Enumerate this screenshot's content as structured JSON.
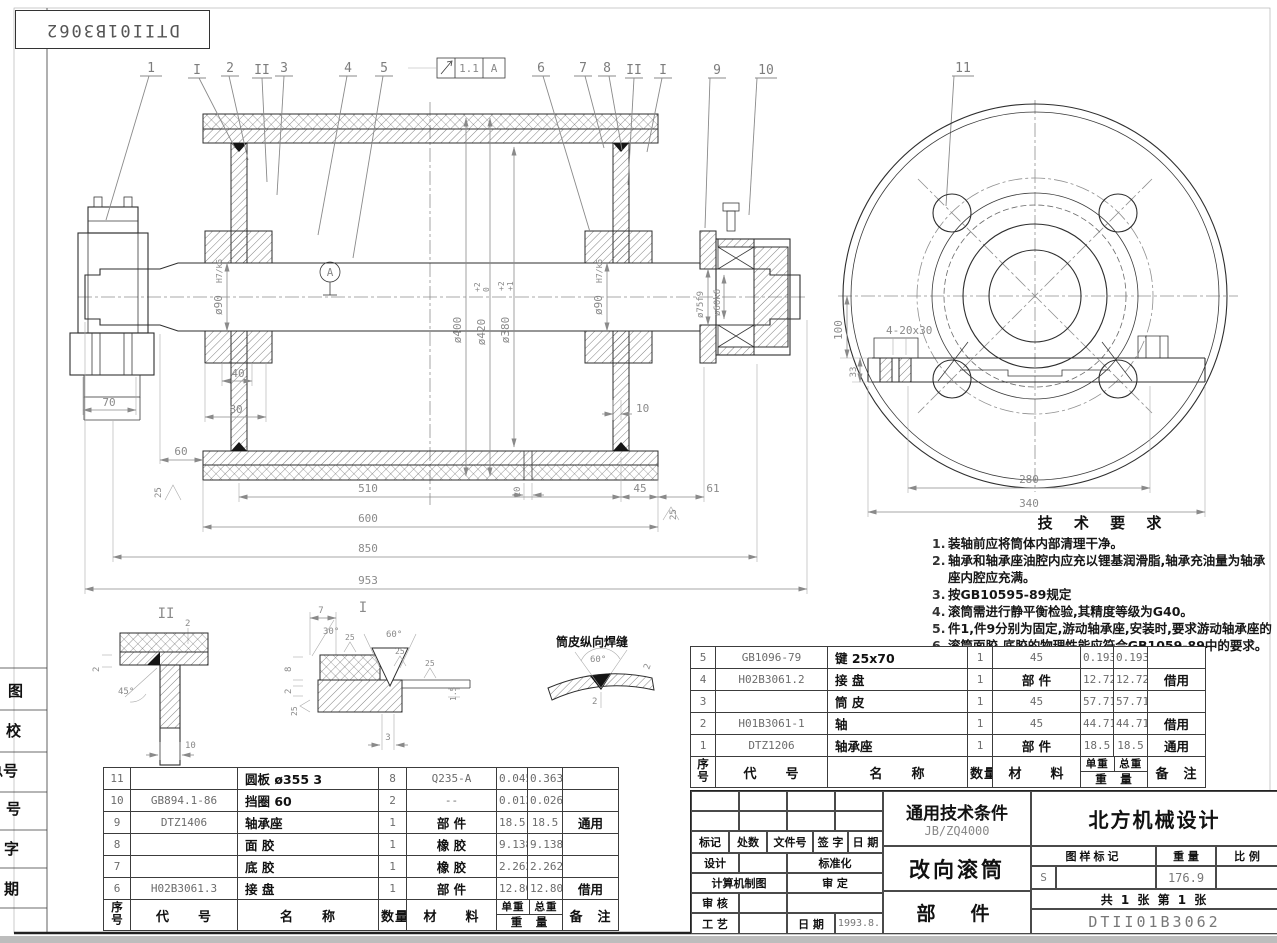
{
  "ink": "#1a1a1a",
  "dim_color": "#8a8a8a",
  "sheet": {
    "mirrored_label": "DTII01B3062",
    "side_labels": [
      "图",
      "校",
      "总号",
      "号",
      "字",
      "期"
    ]
  },
  "balloons": {
    "n1": "1",
    "rI_left": "I",
    "n2": "2",
    "rII_left": "II",
    "n3": "3",
    "n4": "4",
    "n5": "5",
    "n6": "6",
    "n7": "7",
    "n8": "8",
    "rII_right": "II",
    "rI_right": "I",
    "n9": "9",
    "n10": "10",
    "n11": "11"
  },
  "tolerance_frame": {
    "value": "1.1",
    "datum": "A"
  },
  "datum_label": "A",
  "dims_main": {
    "dia420": "ø420",
    "dia420_up": "+2",
    "dia420_dn": "0",
    "dia400": "ø400",
    "dia380": "ø380",
    "dia380_up": "+2",
    "dia380_dn": "+1",
    "dia90": "ø90",
    "fit90": "H7/k6",
    "dia75": "ø75f9",
    "dia60": "ø60k6",
    "d70": "70",
    "d60": "60",
    "d40": "40",
    "d80": "80",
    "d10_disc": "10",
    "d510": "510",
    "d10_mid": "10",
    "d45": "45",
    "d61": "61",
    "d600": "600",
    "d850": "850",
    "d953": "953",
    "ra25": "25"
  },
  "dims_circ": {
    "d100": "100",
    "d33": "33",
    "holes": "4-20x30",
    "d280": "280",
    "d340": "340"
  },
  "details": {
    "sec2_label": "II",
    "sec2_t2": "2",
    "sec2_s2": "2",
    "sec2_45": "45°",
    "sec2_10": "10",
    "sec1_label": "I",
    "sec1_7": "7",
    "sec1_30": "30°",
    "sec1_60": "60°",
    "sec1_8": "8",
    "sec1_2": "2",
    "sec1_15": "1.5",
    "sec1_3": "3",
    "seam_title": "筒皮纵向焊缝",
    "seam_60": "60°",
    "seam_2a": "2",
    "seam_2b": "2"
  },
  "tech_req": {
    "title": "技 术 要 求",
    "items": [
      {
        "no": "1.",
        "text": "装轴前应将筒体内部清理干净。"
      },
      {
        "no": "2.",
        "text": "轴承和轴承座油腔内应充以锂基润滑脂,轴承充油量为轴承"
      },
      {
        "no": "",
        "text": "座内腔应充满。"
      },
      {
        "no": "3.",
        "text": "按GB10595-89规定"
      },
      {
        "no": "4.",
        "text": "滚筒需进行静平衡检验,其精度等级为G40。"
      },
      {
        "no": "5.",
        "text": "件1,件9分别为固定,游动轴承座,安装时,要求游动轴承座的"
      },
      {
        "no": "6.",
        "text": "滚筒面胶,底胶的物理性能应符合GB1059-89中的要求。"
      }
    ]
  },
  "bom_right": {
    "headers": {
      "seq": "序号",
      "code": "代　　号",
      "name": "名　　称",
      "qty": "数量",
      "mat": "材　　料",
      "unit": "单重",
      "total": "总重",
      "weight": "重　量",
      "note": "备　注"
    },
    "rows": [
      {
        "seq": "5",
        "code": "GB1096-79",
        "name": "键  25x70",
        "qty": "1",
        "mat": "45",
        "unit": "0.193",
        "total": "0.193",
        "note": ""
      },
      {
        "seq": "4",
        "code": "H02B3061.2",
        "name": "接  盘",
        "qty": "1",
        "mat": "部  件",
        "unit": "12.72",
        "total": "12.72",
        "note": "借用"
      },
      {
        "seq": "3",
        "code": "",
        "name": "筒  皮",
        "qty": "1",
        "mat": "45",
        "unit": "57.71",
        "total": "57.71",
        "note": ""
      },
      {
        "seq": "2",
        "code": "H01B3061-1",
        "name": "轴",
        "qty": "1",
        "mat": "45",
        "unit": "44.71",
        "total": "44.71",
        "note": "借用"
      },
      {
        "seq": "1",
        "code": "DTZ1206",
        "name": "轴承座",
        "qty": "1",
        "mat": "部  件",
        "unit": "18.5",
        "total": "18.5",
        "note": "通用"
      }
    ]
  },
  "bom_left": {
    "headers": {
      "seq": "序号",
      "code": "代　　号",
      "name": "名　　称",
      "qty": "数量",
      "mat": "材　　料",
      "unit": "单重",
      "total": "总重",
      "weight": "重　量",
      "note": "备　注"
    },
    "rows": [
      {
        "seq": "11",
        "code": "",
        "name": "圆板  ø355   3",
        "qty": "8",
        "mat": "Q235-A",
        "unit": "0.045",
        "total": "0.363",
        "note": ""
      },
      {
        "seq": "10",
        "code": "GB894.1-86",
        "name": "挡圈  60",
        "qty": "2",
        "mat": "--",
        "unit": "0.013",
        "total": "0.026",
        "note": ""
      },
      {
        "seq": "9",
        "code": "DTZ1406",
        "name": "轴承座",
        "qty": "1",
        "mat": "部  件",
        "unit": "18.5",
        "total": "18.5",
        "note": "通用"
      },
      {
        "seq": "8",
        "code": "",
        "name": "面  胶",
        "qty": "1",
        "mat": "橡  胶",
        "unit": "9.138",
        "total": "9.138",
        "note": ""
      },
      {
        "seq": "7",
        "code": "",
        "name": "底  胶",
        "qty": "1",
        "mat": "橡  胶",
        "unit": "2.262",
        "total": "2.262",
        "note": ""
      },
      {
        "seq": "6",
        "code": "H02B3061.3",
        "name": "接  盘",
        "qty": "1",
        "mat": "部  件",
        "unit": "12.80",
        "total": "12.80",
        "note": "借用"
      }
    ]
  },
  "title_block": {
    "std_title": "通用技术条件",
    "std_code": "JB/ZQ4000",
    "product": "改向滚筒",
    "part_type": "部　件",
    "company": "北方机械设计",
    "rev_headers": [
      "标记",
      "处数",
      "文件号",
      "签 字",
      "日 期"
    ],
    "roles": {
      "design": "设计",
      "std": "标准化",
      "cad": "计算机制图",
      "approve": "审 定",
      "check": "审 核",
      "craft": "工 艺",
      "date_label": "日 期",
      "date": "1993.8."
    },
    "mark_headers": [
      "图样标记",
      "重 量",
      "比 例"
    ],
    "mark_s": "S",
    "weight": "176.9",
    "sheet_info": "共 1 张  第 1 张",
    "drawing_no": "DTII01B3062"
  }
}
